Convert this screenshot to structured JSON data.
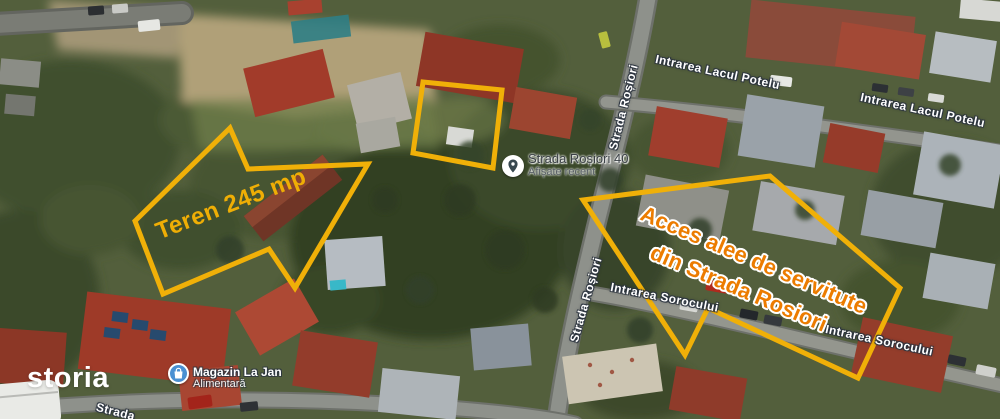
{
  "map": {
    "street_labels": [
      {
        "id": "intrarea-lacul-potelu-1",
        "text": "Intrarea Lacul Potelu"
      },
      {
        "id": "intrarea-lacul-potelu-2",
        "text": "Intrarea Lacul Potelu"
      },
      {
        "id": "strada-rosiori-1",
        "text": "Strada Roșiori"
      },
      {
        "id": "strada-rosiori-2",
        "text": "Strada Roșiori"
      },
      {
        "id": "intrarea-sorocului-1",
        "text": "Intrarea Sorocului"
      },
      {
        "id": "intrarea-sorocului-2",
        "text": "Intrarea Sorocului"
      },
      {
        "id": "bottom-partial-street",
        "text": "Strada"
      }
    ],
    "place_marker": {
      "icon": "location-pin-icon",
      "title": "Strada Roșiori 40",
      "subtitle": "Afișate recent"
    },
    "poi": {
      "icon": "shopping-bag-icon",
      "title": "Magazin La Jan",
      "subtitle": "Alimentară"
    }
  },
  "annotations": {
    "land_area_label": "Teren 245 mp",
    "access_label_line1": "Acces alee de servitute",
    "access_label_line2": "din Strada Rosiori",
    "outline_color": "#F0B008",
    "land_text_color": "#EFAE05",
    "access_text_color": "#EC7C00"
  },
  "watermark": {
    "brand": "storia"
  },
  "colors": {
    "poi_icon_blue": "#4A90D2",
    "street_label_text": "#FFFFFF",
    "place_marker_text": "#3A4045"
  }
}
